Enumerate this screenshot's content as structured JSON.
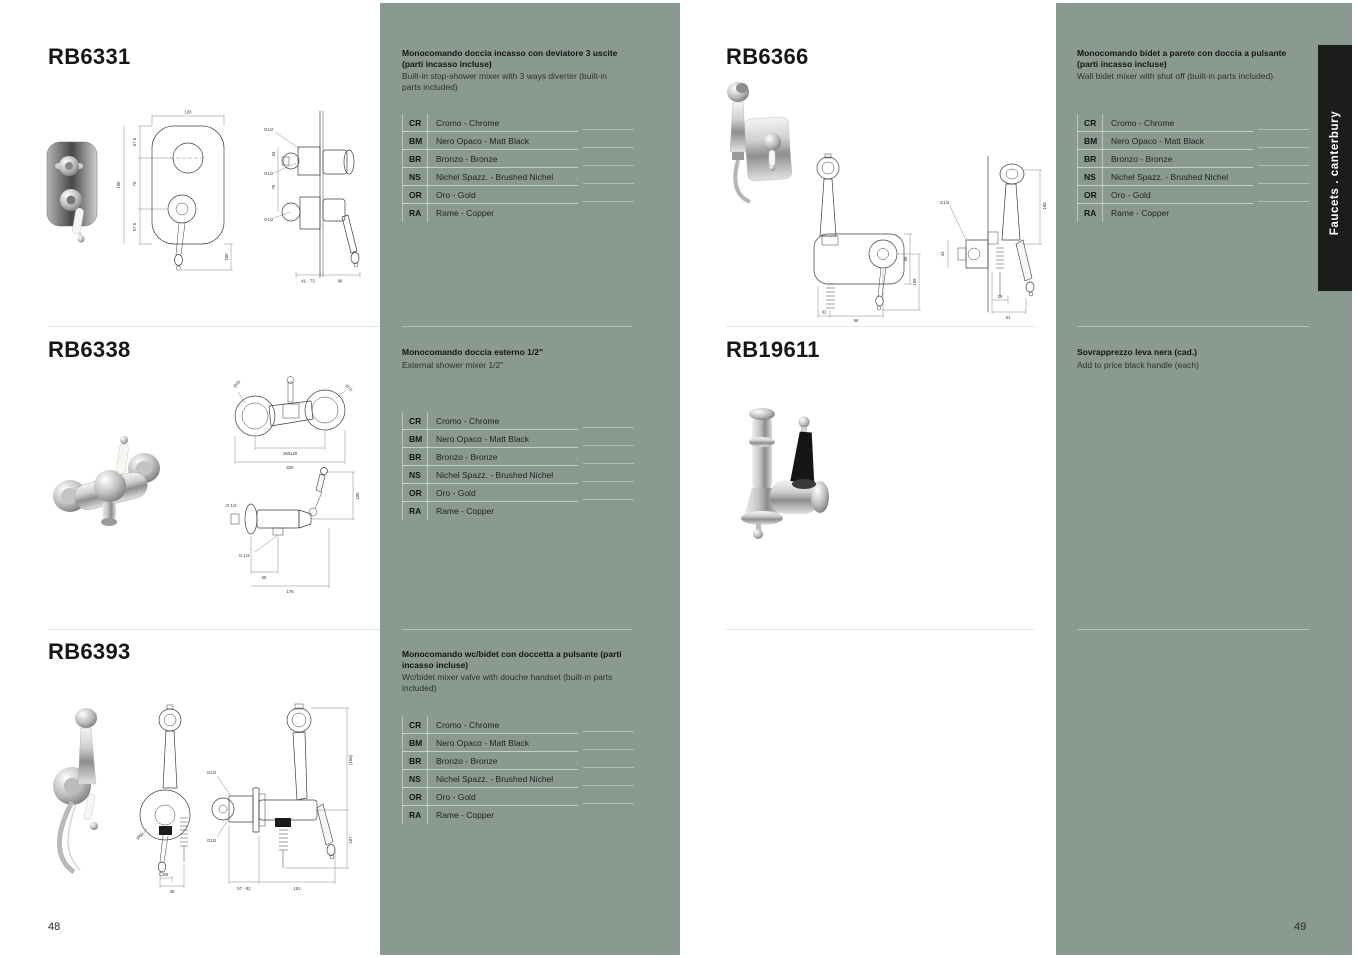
{
  "page": {
    "left_number": "48",
    "right_number": "49",
    "side_tab_label": "Faucets . canterbury"
  },
  "colors": {
    "panel_green": "#8a9a91",
    "tab_black": "#1c1c1a",
    "page_white": "#ffffff",
    "text_dark": "#1a1a1a"
  },
  "finishes": [
    {
      "code": "CR",
      "name": "Cromo - Chrome"
    },
    {
      "code": "BM",
      "name": "Nero Opaco - Matt Black"
    },
    {
      "code": "BR",
      "name": "Bronzo - Bronze"
    },
    {
      "code": "NS",
      "name": "Nichel Spazz. - Brushed Nichel"
    },
    {
      "code": "OR",
      "name": "Oro - Gold"
    },
    {
      "code": "RA",
      "name": "Rame - Copper"
    }
  ],
  "products": {
    "rb6331": {
      "code": "RB6331",
      "title_it": "Monocomando doccia incasso con deviatore 3 uscite (parti incasso incluse)",
      "desc_en": "Built-in stop-shower mixer with 3 ways diverter (built-in parts included)",
      "dims": {
        "w": "120",
        "seg1": "57.5",
        "seg2": "75",
        "seg3": "57.5",
        "h": "190",
        "lever": "100",
        "g1": "G1/2",
        "g2": "G1/2",
        "g3": "G1/2",
        "side1": "34",
        "side2": "75",
        "depth": "41 - 73",
        "proj": "99"
      }
    },
    "rb6338": {
      "code": "RB6338",
      "title_it": "Monocomando doccia esterno 1/2\"",
      "desc_en": "External shower mixer 1/2\"",
      "dims": {
        "dia1": "Ø70",
        "dia2": "Ø70",
        "centers": "150±20",
        "width": "220",
        "g1": "G 1/2",
        "g2": "G 1/2",
        "b1": "66",
        "b2": "175",
        "h": "109"
      }
    },
    "rb6393": {
      "code": "RB6393",
      "title_it": "Monocomando wc/bidet con doccetta a pulsante (parti incasso incluse)",
      "desc_en": "Wc/bidet mixer valve with douche handset (built-in parts included)",
      "dims": {
        "dia": "Ø60",
        "b1": "26",
        "b2": "40",
        "g1": "G1/2",
        "g2": "G1/2",
        "h1": "(156)",
        "h2": "107",
        "s1": "57 - 82",
        "s2": "161"
      }
    },
    "rb6366": {
      "code": "RB6366",
      "title_it": "Monocomando bidet a parete con doccia a pulsante (parti incasso incluse)",
      "desc_en": "Wall bidet mixer with shut off (built-in parts included)",
      "dims": {
        "b1": "32",
        "b2": "66",
        "r1": "90",
        "r2": "109",
        "g1": "G1/2",
        "l1": "43",
        "s1": "29",
        "s2": "51",
        "r3": "150"
      }
    },
    "rb19611": {
      "code": "RB19611",
      "title_it": "Sovrapprezzo leva nera (cad.)",
      "desc_en": "Add to price black handle (each)"
    }
  }
}
